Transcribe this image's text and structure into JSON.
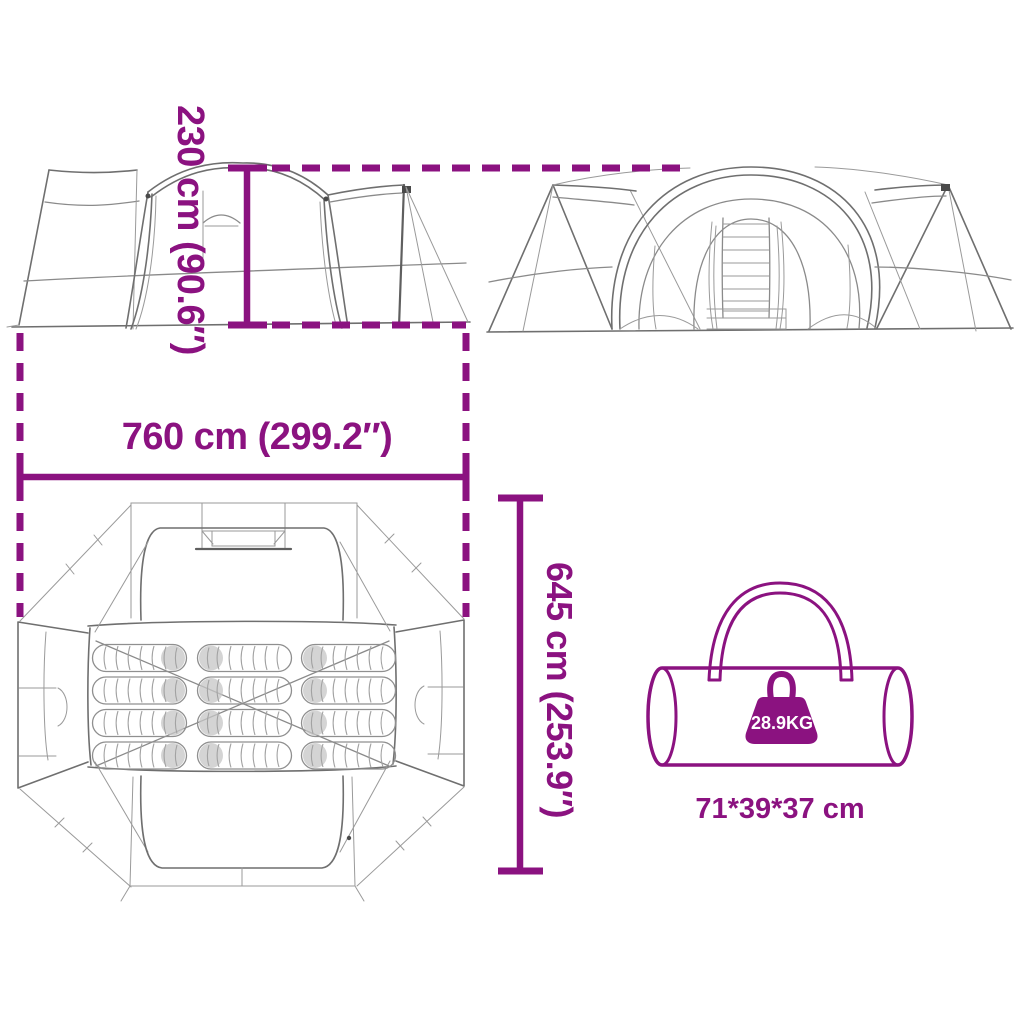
{
  "diagram": {
    "accent_color": "#8B1280",
    "sketch_color": "#6f6f6f",
    "labels": {
      "tent_height": "230 cm (90.6″)",
      "tent_width": "760 cm (299.2″)",
      "tent_depth": "645 cm (253.9″)",
      "bag_weight": "28.9KG",
      "bag_size": "71*39*37 cm"
    },
    "views": {
      "side_view": "tent side elevation sketch",
      "front_view": "tent front elevation sketch",
      "floor_plan": "tent top view floor plan sketch",
      "package": "carry bag sketch"
    },
    "floor_plan": {
      "sleeping_bag_count": 12
    },
    "icons": {
      "weight": "weight-icon",
      "carry_bag": "carry-bag-icon"
    }
  }
}
